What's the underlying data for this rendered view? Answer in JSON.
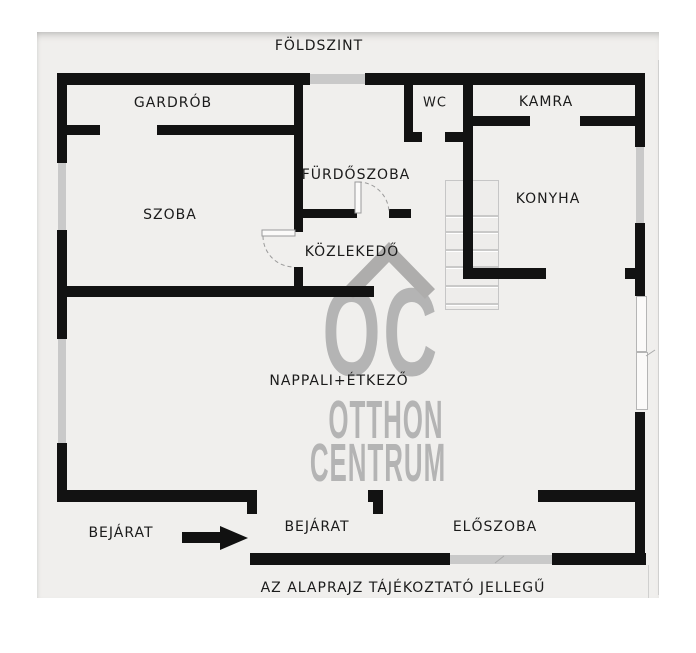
{
  "page": {
    "title": "FÖLDSZINT",
    "footer": "AZ ALAPRAJZ TÁJÉKOZTATÓ JELLEGŰ"
  },
  "rooms": {
    "gardrob": "GARDRÓB",
    "wc": "WC",
    "kamra": "KAMRA",
    "szoba": "SZOBA",
    "furdoszoba": "FÜRDŐSZOBA",
    "konyha": "KONYHA",
    "kozlekedo": "KÖZLEKEDŐ",
    "nappali": "NAPPALI+ÉTKEZŐ",
    "eloszoba": "ELŐSZOBA",
    "bejarat_outside": "BEJÁRAT",
    "bejarat_porch": "BEJÁRAT"
  },
  "watermark": {
    "monogram": "OC",
    "name_line1": "OTTHON",
    "name_line2": "CENTRUM"
  },
  "colors": {
    "wall": "#121212",
    "plan_background": "#f0efed",
    "window_marker": "#c9c9c9",
    "watermark_gray": "#b4b4b4",
    "label_text": "#1b1b1b"
  }
}
